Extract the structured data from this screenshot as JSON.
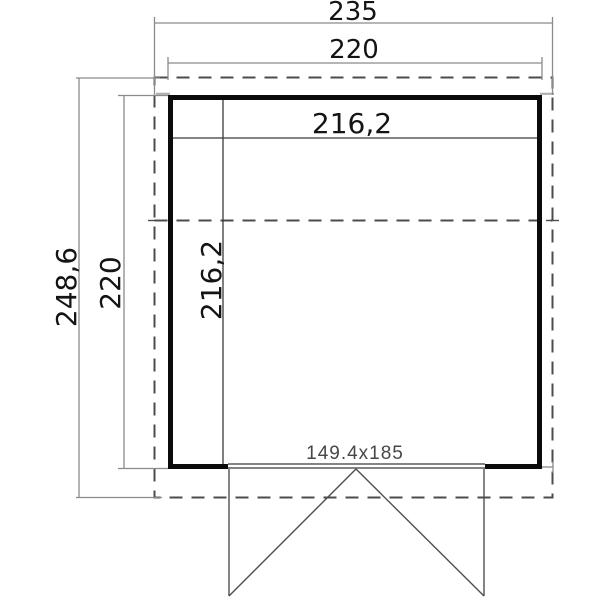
{
  "drawing": {
    "type": "floor-plan",
    "unit": "cm",
    "labels": {
      "overall_width": "235",
      "outer_width": "220",
      "inner_width": "216,2",
      "overall_depth": "248,6",
      "outer_depth": "220",
      "inner_depth": "216,2",
      "door_size": "149.4x185"
    },
    "measurements": {
      "overall_width_cm": 235,
      "outer_width_cm": 220,
      "inner_width_cm": 216.2,
      "overall_depth_cm": 248.6,
      "outer_depth_cm": 220,
      "inner_depth_cm": 216.2,
      "door_size_cm": "149.4x185"
    },
    "colors": {
      "background": "#ffffff",
      "wall": "#0b0b0b",
      "dash": "#4c4c4c",
      "dim": "#8a8a8a",
      "inner": "#3a3a3a",
      "door": "#4f4f4f",
      "stub": "#b0b0b0",
      "text": "#141414",
      "door_label": "#474747"
    }
  }
}
